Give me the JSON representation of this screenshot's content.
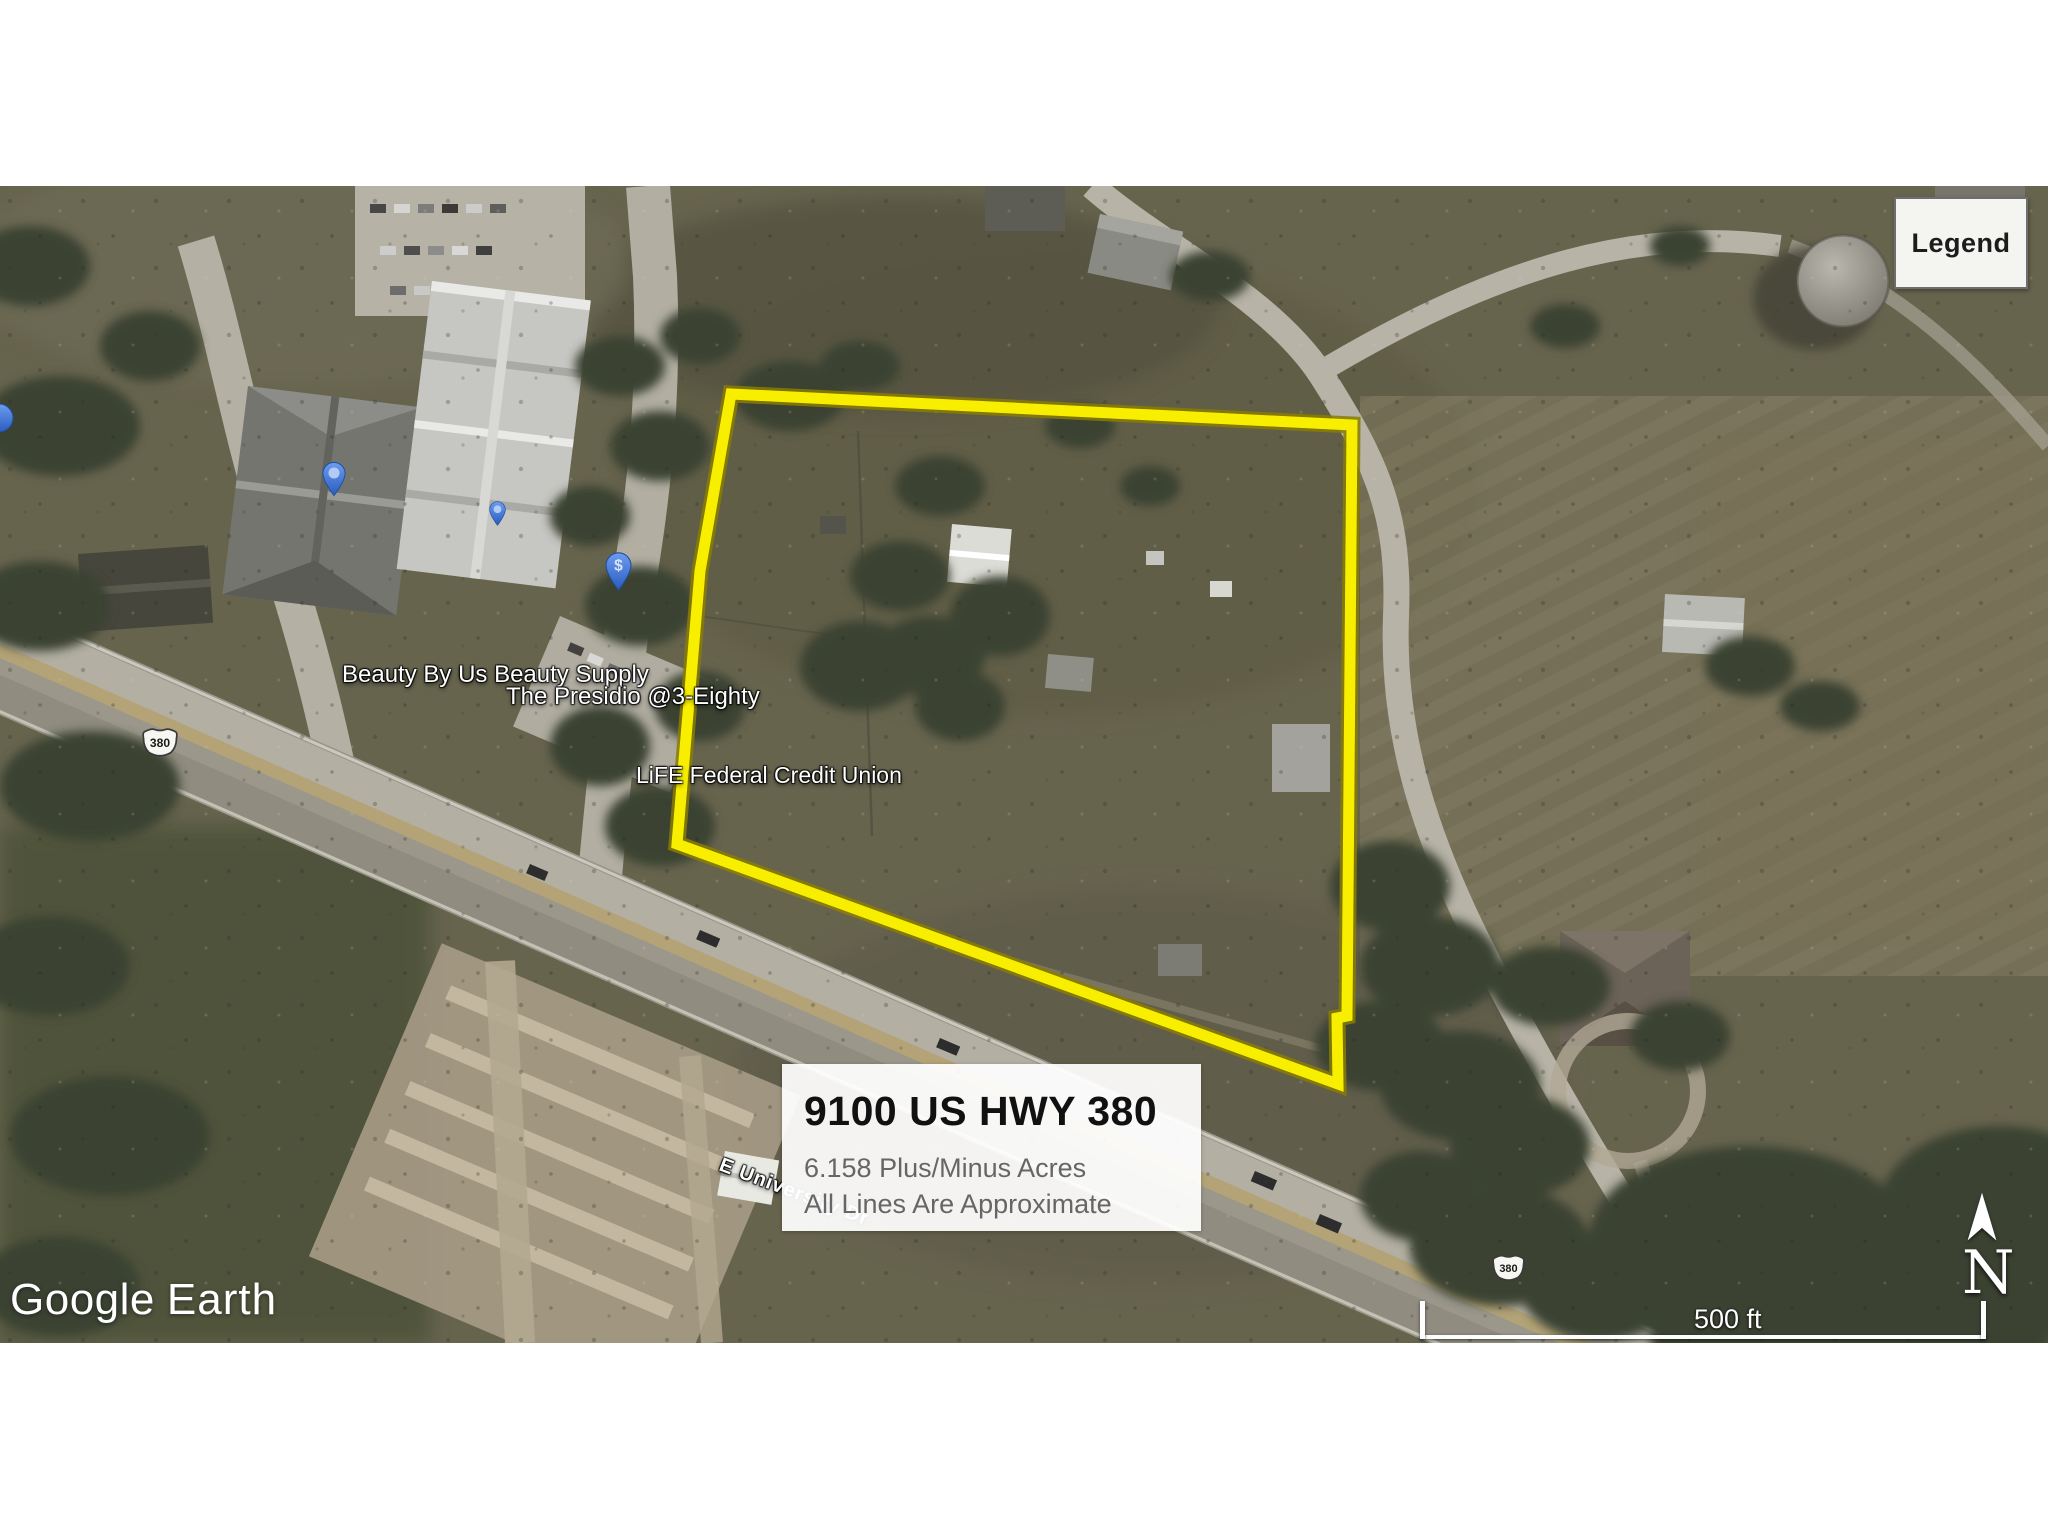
{
  "map": {
    "legend_button_label": "Legend",
    "attribution": {
      "brand": "Google",
      "product": "Earth"
    },
    "scale_bar": {
      "label": "500 ft"
    },
    "compass": {
      "north_label": "N"
    },
    "info_box": {
      "title": "9100 US HWY 380",
      "acreage": "6.158 Plus/Minus Acres",
      "disclaimer": "All Lines Are Approximate"
    },
    "place_labels": [
      {
        "name": "Beauty By Us Beauty Supply"
      },
      {
        "name": "The Presidio @3-Eighty"
      },
      {
        "name": "LiFE Federal Credit Union"
      }
    ],
    "road_label": "E University Dr",
    "route_shields": [
      {
        "number": "380"
      },
      {
        "number": "380"
      }
    ],
    "pins": {
      "dollar_glyph": "$"
    },
    "colors": {
      "boundary_yellow": "#f8ef00",
      "pin_blue": "#3f76d6",
      "legend_background": "#f4f4f1",
      "info_box_background": "#ffffff"
    }
  }
}
